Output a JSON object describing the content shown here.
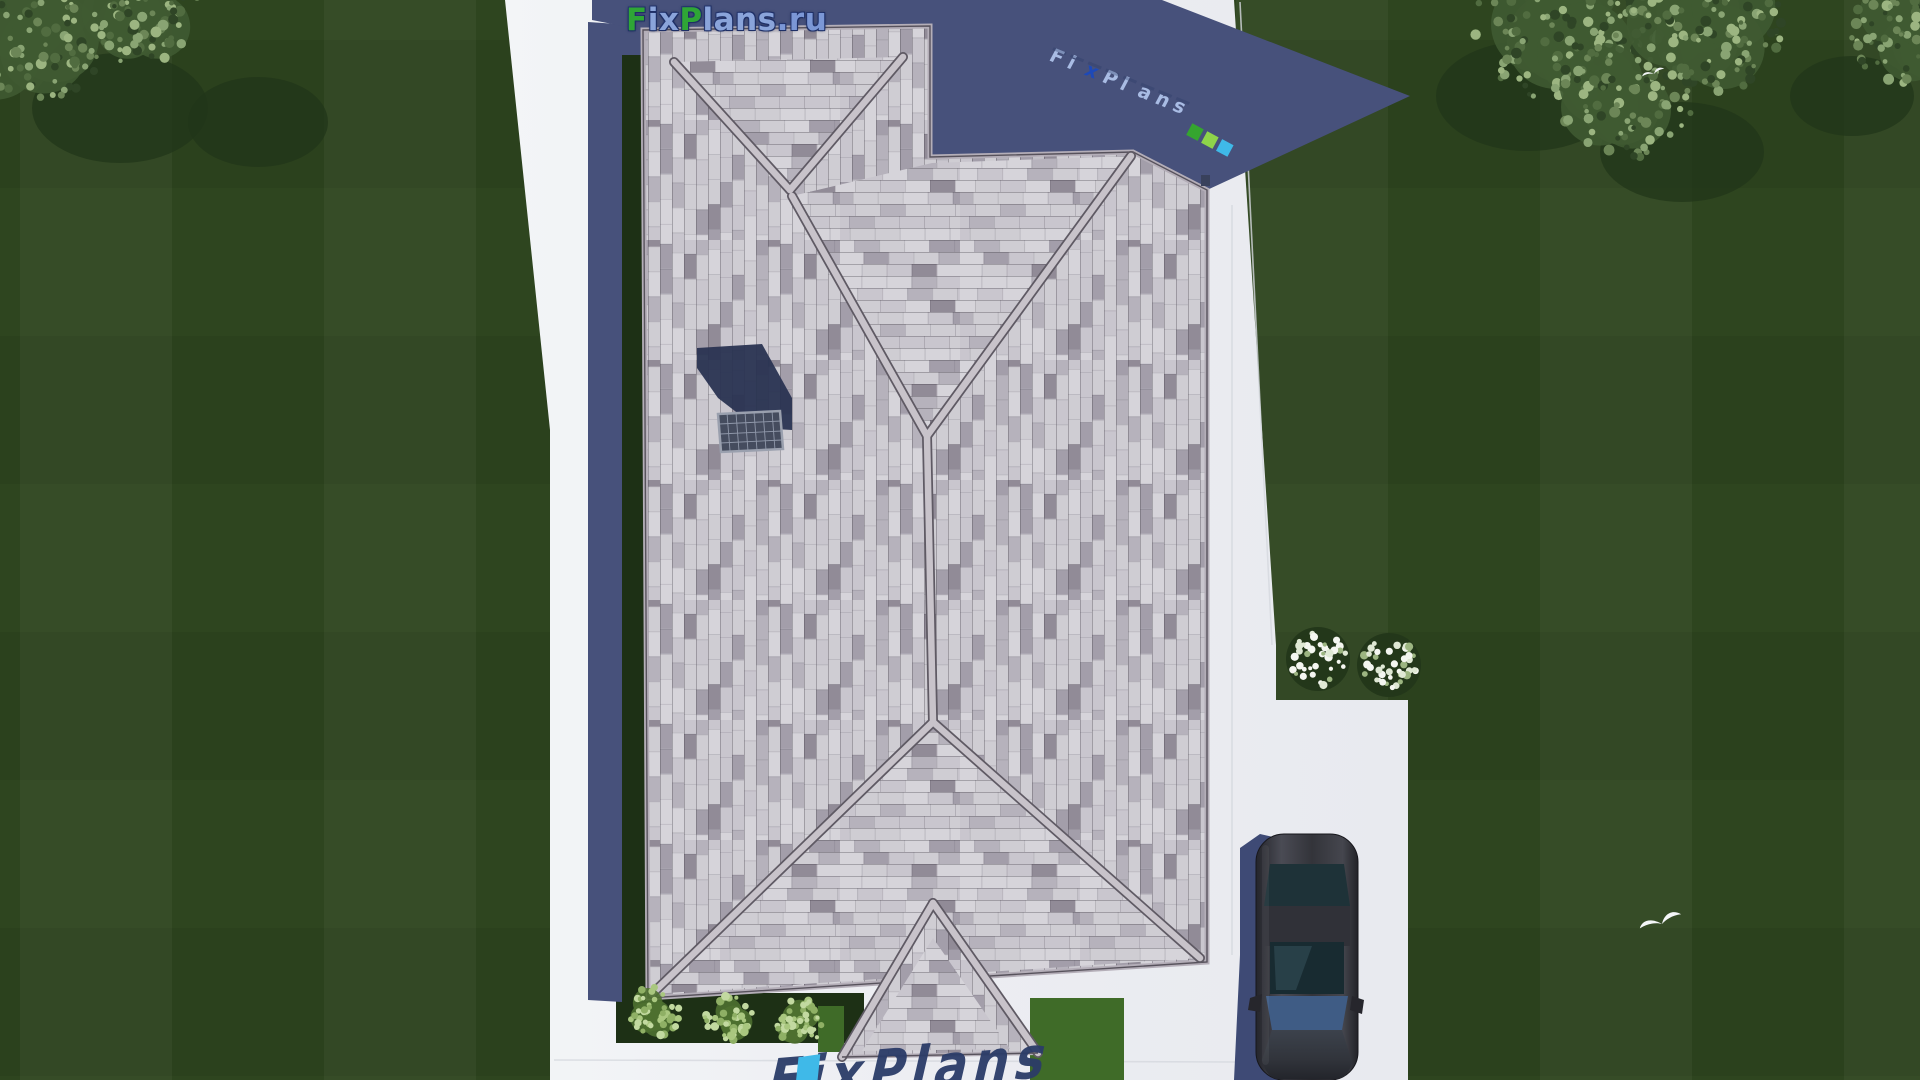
{
  "app": {
    "type": "3d-architectural-render",
    "view": "top-down aerial roof plan of a single-family house",
    "site": "house with hip roof, lawn, concrete path, driveway with parked car"
  },
  "watermarks": {
    "top": {
      "text": "FixPlans.ru",
      "segments": [
        {
          "text": "F",
          "color": "#2fa636"
        },
        {
          "text": "ix",
          "color": "#8aa4da"
        },
        {
          "text": "P",
          "color": "#2fa636"
        },
        {
          "text": "lans",
          "color": "#8aa4da"
        },
        {
          "text": ".ru",
          "color": "#7b97d6"
        }
      ]
    },
    "diagonal": {
      "letters": [
        {
          "ch": "F",
          "color": "#a9bce4"
        },
        {
          "ch": "i",
          "color": "#a9bce4"
        },
        {
          "ch": "x",
          "color": "#1d49b8"
        },
        {
          "ch": "P",
          "color": "#a9bce4"
        },
        {
          "ch": "l",
          "color": "#a9bce4"
        },
        {
          "ch": "a",
          "color": "#a9bce4"
        },
        {
          "ch": "n",
          "color": "#a9bce4"
        },
        {
          "ch": "s",
          "color": "#a9bce4"
        }
      ],
      "squares": [
        {
          "color": "#35a52f"
        },
        {
          "color": "#8ed44a"
        },
        {
          "color": "#3fb9e8"
        }
      ]
    },
    "bottom": {
      "text": "FixPlans",
      "accent_color": "#3fb9e8"
    }
  },
  "palette": {
    "grass": "#2e451f",
    "grass_dark": "#22351a",
    "canopy_base": "#3f5a32",
    "canopy_dots": [
      "#89a473",
      "#9cb581",
      "#6c8657",
      "#516c40",
      "#2f4526"
    ],
    "path": "#edeff3",
    "joint": "#d6d9df",
    "shadow": "#47517b",
    "shadow_dark": "#283251",
    "roof_tones": [
      "#d6d4da",
      "#c9c6ce",
      "#b6b2bc",
      "#a39eaa",
      "#918b97",
      "#cfcdd3"
    ],
    "roof_line": "#57525c",
    "ridge": "#c8c3ca",
    "garden": "#1d3015",
    "bush_base": "#4e7030",
    "bush_dots": [
      "#a9c77f",
      "#8fb065",
      "#c2d9a0"
    ],
    "bright_grass": "#3f6b28",
    "flower_base": "#23371a",
    "flower": "#f4f6f0",
    "car_body": "#33343a",
    "car_glass": "#1e3238",
    "car_windshield": "#3f5c85",
    "car_shadow": "#3e4a75",
    "wm_navy": "#2b3c68",
    "wm_cyan": "#3fb9e8"
  },
  "scene": {
    "trees": [
      {
        "cx": 30,
        "cy": 28,
        "r": 80
      },
      {
        "cx": 142,
        "cy": 10,
        "r": 58
      },
      {
        "cx": 1560,
        "cy": 18,
        "r": 88
      },
      {
        "cx": 1625,
        "cy": 92,
        "r": 70
      },
      {
        "cx": 1706,
        "cy": 24,
        "r": 76
      },
      {
        "cx": 1906,
        "cy": 28,
        "r": 58
      }
    ],
    "tree_shadows": [
      {
        "cx": 120,
        "cy": 108,
        "rx": 88,
        "ry": 55
      },
      {
        "cx": 258,
        "cy": 122,
        "rx": 70,
        "ry": 45
      },
      {
        "cx": 1528,
        "cy": 96,
        "rx": 92,
        "ry": 55
      },
      {
        "cx": 1682,
        "cy": 152,
        "rx": 82,
        "ry": 50
      },
      {
        "cx": 1852,
        "cy": 96,
        "rx": 62,
        "ry": 40
      }
    ],
    "bushes": [
      {
        "cx": 655,
        "cy": 1012,
        "r": 27
      },
      {
        "cx": 729,
        "cy": 1018,
        "r": 24
      },
      {
        "cx": 800,
        "cy": 1022,
        "r": 24
      }
    ],
    "flower_clusters": [
      {
        "cx": 1318,
        "cy": 659,
        "r": 28
      },
      {
        "cx": 1389,
        "cy": 665,
        "r": 28
      }
    ],
    "birds": [
      {
        "x": 1654,
        "y": 74,
        "s": 0.8
      },
      {
        "x": 1662,
        "y": 924,
        "s": 1.5
      }
    ],
    "car": {
      "type": "sedan",
      "body_color": "dark-gray",
      "parked_on": "driveway"
    }
  }
}
